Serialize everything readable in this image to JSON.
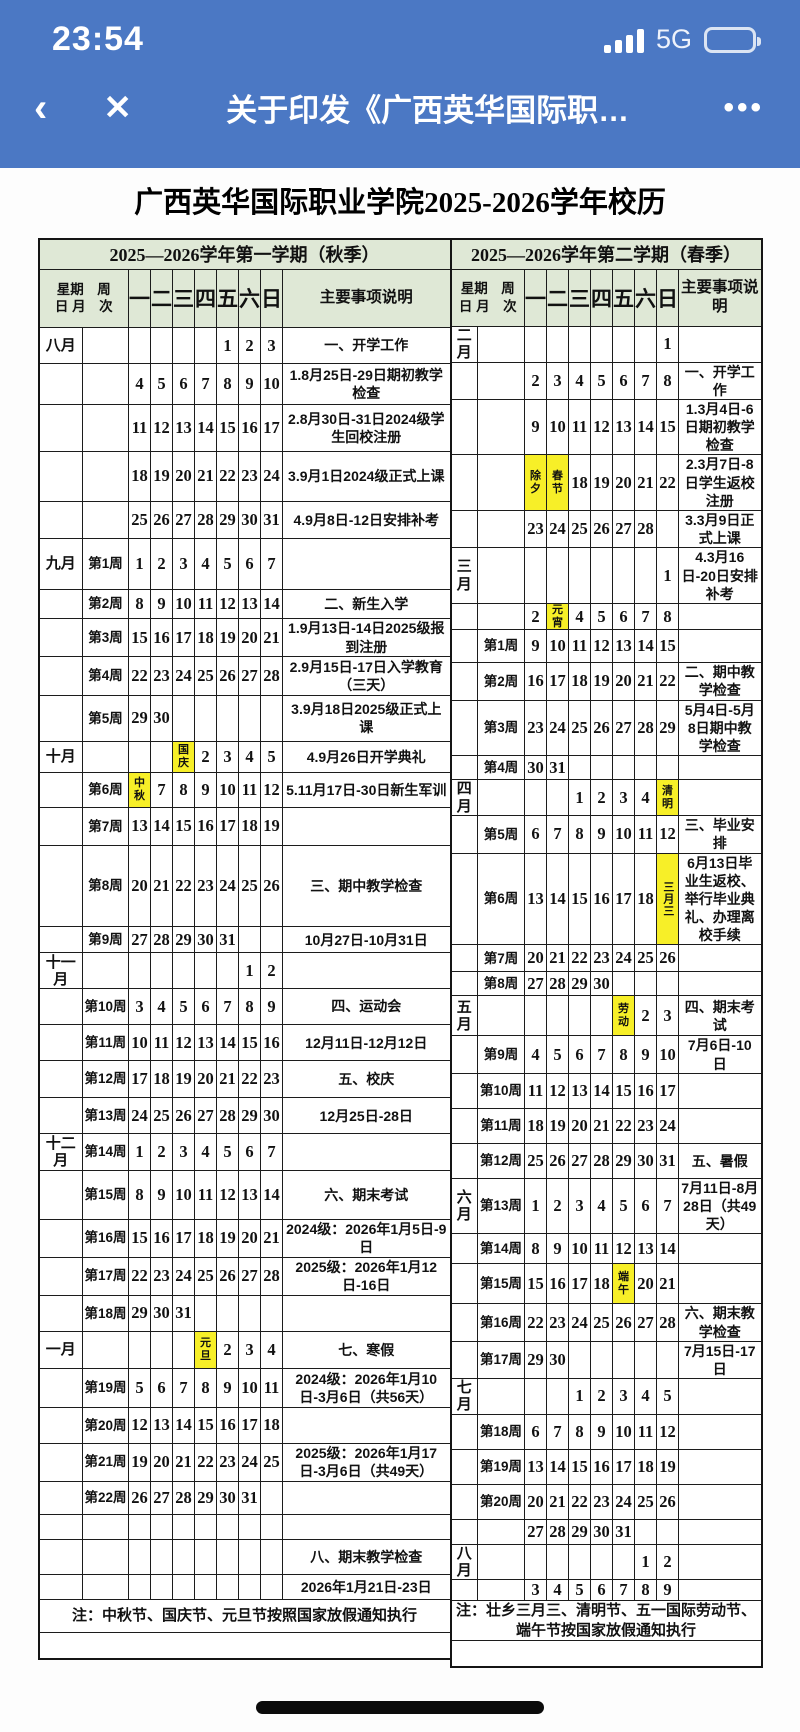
{
  "status_bar": {
    "time": "23:54",
    "network": "5G"
  },
  "nav": {
    "back_icon": "‹",
    "close_icon": "✕",
    "title": "关于印发《广西英华国际职…",
    "more_icon": "•••"
  },
  "page": {
    "title": "广西英华国际职业学院2025-2026学年校历"
  },
  "colors": {
    "nav_blue": "#4b78c4",
    "header_green": "#dfe8d6",
    "holiday_yellow": "#f7ef28"
  },
  "calendars": [
    {
      "title": "2025—2026学年第一学期（秋季）",
      "corner": "星期　周\n日 月　次",
      "day_headers": [
        "一",
        "二",
        "三",
        "四",
        "五",
        "六",
        "日"
      ],
      "notes_header": "主要事项说明",
      "rows": [
        {
          "m": "八月",
          "w": "",
          "d": [
            "",
            "",
            "",
            "",
            "1",
            "2",
            "3"
          ],
          "note": "一、开学工作",
          "h": 36
        },
        {
          "m": "",
          "w": "",
          "d": [
            "4",
            "5",
            "6",
            "7",
            "8",
            "9",
            "10"
          ],
          "note": "1.8月25日-29日期初教学检查",
          "h": 40
        },
        {
          "m": "",
          "w": "",
          "d": [
            "11",
            "12",
            "13",
            "14",
            "15",
            "16",
            "17"
          ],
          "note": "2.8月30日-31日2024级学生回校注册",
          "h": 46
        },
        {
          "m": "",
          "w": "",
          "d": [
            "18",
            "19",
            "20",
            "21",
            "22",
            "23",
            "24"
          ],
          "note": "3.9月1日2024级正式上课",
          "h": 50
        },
        {
          "m": "",
          "w": "",
          "d": [
            "25",
            "26",
            "27",
            "28",
            "29",
            "30",
            "31"
          ],
          "note": "4.9月8日-12日安排补考",
          "h": 36
        },
        {
          "m": "九月",
          "w": "第1周",
          "d": [
            "1",
            "2",
            "3",
            "4",
            "5",
            "6",
            "7"
          ],
          "note": "",
          "h": 50
        },
        {
          "m": "",
          "w": "第2周",
          "d": [
            "8",
            "9",
            "10",
            "11",
            "12",
            "13",
            "14"
          ],
          "note": "二、新生入学",
          "h": 29
        },
        {
          "m": "",
          "w": "第3周",
          "d": [
            "15",
            "16",
            "17",
            "18",
            "19",
            "20",
            "21"
          ],
          "note": "1.9月13日-14日2025级报到注册",
          "h": 33
        },
        {
          "m": "",
          "w": "第4周",
          "d": [
            "22",
            "23",
            "24",
            "25",
            "26",
            "27",
            "28"
          ],
          "note": "2.9月15日-17日入学教育（三天）",
          "h": 38
        },
        {
          "m": "",
          "w": "第5周",
          "d": [
            "29",
            "30",
            "",
            "",
            "",
            "",
            ""
          ],
          "note": "3.9月18日2025级正式上课",
          "h": 46
        },
        {
          "m": "十月",
          "w": "",
          "d": [
            "",
            "",
            {
              "t": "国庆",
              "hl": true
            },
            "2",
            "3",
            "4",
            "5"
          ],
          "note": "4.9月26日开学典礼",
          "h": 30
        },
        {
          "m": "",
          "w": "第6周",
          "d": [
            {
              "t": "中秋",
              "hl": true
            },
            "7",
            "8",
            "9",
            "10",
            "11",
            "12"
          ],
          "note": "5.11月17日-30日新生军训",
          "h": 35
        },
        {
          "m": "",
          "w": "第7周",
          "d": [
            "13",
            "14",
            "15",
            "16",
            "17",
            "18",
            "19"
          ],
          "note": "",
          "h": 37
        },
        {
          "m": "",
          "w": "第8周",
          "d": [
            "20",
            "21",
            "22",
            "23",
            "24",
            "25",
            "26"
          ],
          "note": "三、期中教学检查",
          "h": 80
        },
        {
          "m": "",
          "w": "第9周",
          "d": [
            "27",
            "28",
            "29",
            "30",
            "31",
            "",
            ""
          ],
          "note": "10月27日-10月31日",
          "h": 26
        },
        {
          "m": "十一月",
          "w": "",
          "d": [
            "",
            "",
            "",
            "",
            "",
            "1",
            "2"
          ],
          "note": "",
          "h": 34
        },
        {
          "m": "",
          "w": "第10周",
          "d": [
            "3",
            "4",
            "5",
            "6",
            "7",
            "8",
            "9"
          ],
          "note": "四、运动会",
          "h": 35
        },
        {
          "m": "",
          "w": "第11周",
          "d": [
            "10",
            "11",
            "12",
            "13",
            "14",
            "15",
            "16"
          ],
          "note": "12月11日-12月12日",
          "h": 36
        },
        {
          "m": "",
          "w": "第12周",
          "d": [
            "17",
            "18",
            "19",
            "20",
            "21",
            "22",
            "23"
          ],
          "note": "五、校庆",
          "h": 36
        },
        {
          "m": "",
          "w": "第13周",
          "d": [
            "24",
            "25",
            "26",
            "27",
            "28",
            "29",
            "30"
          ],
          "note": "12月25日-28日",
          "h": 36
        },
        {
          "m": "十二月",
          "w": "第14周",
          "d": [
            "1",
            "2",
            "3",
            "4",
            "5",
            "6",
            "7"
          ],
          "note": "",
          "h": 36
        },
        {
          "m": "",
          "w": "第15周",
          "d": [
            "8",
            "9",
            "10",
            "11",
            "12",
            "13",
            "14"
          ],
          "note": "六、期末考试",
          "h": 48
        },
        {
          "m": "",
          "w": "第16周",
          "d": [
            "15",
            "16",
            "17",
            "18",
            "19",
            "20",
            "21"
          ],
          "note": "2024级：2026年1月5日-9日",
          "h": 37
        },
        {
          "m": "",
          "w": "第17周",
          "d": [
            "22",
            "23",
            "24",
            "25",
            "26",
            "27",
            "28"
          ],
          "note": "2025级：2026年1月12日-16日",
          "h": 35
        },
        {
          "m": "",
          "w": "第18周",
          "d": [
            "29",
            "30",
            "31",
            "",
            "",
            "",
            ""
          ],
          "note": "",
          "h": 36
        },
        {
          "m": "一月",
          "w": "",
          "d": [
            "",
            "",
            "",
            {
              "t": "元旦",
              "hl": true
            },
            "2",
            "3",
            "4"
          ],
          "note": "七、寒假",
          "h": 36
        },
        {
          "m": "",
          "w": "第19周",
          "d": [
            "5",
            "6",
            "7",
            "8",
            "9",
            "10",
            "11"
          ],
          "note": "2024级：2026年1月10日-3月6日（共56天）",
          "h": 39
        },
        {
          "m": "",
          "w": "第20周",
          "d": [
            "12",
            "13",
            "14",
            "15",
            "16",
            "17",
            "18"
          ],
          "note": "",
          "h": 35
        },
        {
          "m": "",
          "w": "第21周",
          "d": [
            "19",
            "20",
            "21",
            "22",
            "23",
            "24",
            "25"
          ],
          "note": "2025级：2026年1月17日-3月6日（共49天）",
          "h": 35
        },
        {
          "m": "",
          "w": "第22周",
          "d": [
            "26",
            "27",
            "28",
            "29",
            "30",
            "31",
            ""
          ],
          "note": "",
          "h": 33
        },
        {
          "m": "",
          "w": "",
          "d": [
            "",
            "",
            "",
            "",
            "",
            "",
            ""
          ],
          "note": "",
          "h": 25
        },
        {
          "m": "",
          "w": "",
          "d": [
            "",
            "",
            "",
            "",
            "",
            "",
            ""
          ],
          "note": "八、期末教学检查",
          "h": 34
        },
        {
          "m": "",
          "w": "",
          "d": [
            "",
            "",
            "",
            "",
            "",
            "",
            ""
          ],
          "note": "2026年1月21日-23日",
          "h": 25
        },
        {
          "span": "注：中秋节、国庆节、元旦节按照国家放假通知执行",
          "h": 32
        },
        {
          "span": "",
          "h": 26
        }
      ]
    },
    {
      "title": "2025—2026学年第二学期（春季）",
      "corner": "星期　周\n日 月　次",
      "day_headers": [
        "一",
        "二",
        "三",
        "四",
        "五",
        "六",
        "日"
      ],
      "notes_header": "主要事项说明",
      "rows": [
        {
          "m": "二月",
          "w": "",
          "d": [
            "",
            "",
            "",
            "",
            "",
            "",
            "1"
          ],
          "note": "",
          "h": 36
        },
        {
          "m": "",
          "w": "",
          "d": [
            "2",
            "3",
            "4",
            "5",
            "6",
            "7",
            "8"
          ],
          "note": "一、开学工作",
          "h": 36
        },
        {
          "m": "",
          "w": "",
          "d": [
            "9",
            "10",
            "11",
            "12",
            "13",
            "14",
            "15"
          ],
          "note": "1.3月4日-6日期初教学检查",
          "h": 48
        },
        {
          "m": "",
          "w": "",
          "d": [
            {
              "t": "除夕",
              "hl": true
            },
            {
              "t": "春节",
              "hl": true
            },
            "18",
            "19",
            "20",
            "21",
            "22"
          ],
          "note": "2.3月7日-8日学生返校注册",
          "h": 53
        },
        {
          "m": "",
          "w": "",
          "d": [
            "23",
            "24",
            "25",
            "26",
            "27",
            "28",
            ""
          ],
          "note": "3.3月9日正式上课",
          "h": 36
        },
        {
          "m": "三月",
          "w": "",
          "d": [
            "",
            "",
            "",
            "",
            "",
            "",
            "1"
          ],
          "note": "4.3月16日-20日安排补考",
          "h": 50
        },
        {
          "m": "",
          "w": "",
          "d": [
            "2",
            {
              "t": "元宵",
              "hl": true
            },
            "4",
            "5",
            "6",
            "7",
            "8"
          ],
          "note": "",
          "h": 26
        },
        {
          "m": "",
          "w": "第1周",
          "d": [
            "9",
            "10",
            "11",
            "12",
            "13",
            "14",
            "15"
          ],
          "note": "",
          "h": 33
        },
        {
          "m": "",
          "w": "第2周",
          "d": [
            "16",
            "17",
            "18",
            "19",
            "20",
            "21",
            "22"
          ],
          "note": "二、期中教学检查",
          "h": 33
        },
        {
          "m": "",
          "w": "第3周",
          "d": [
            "23",
            "24",
            "25",
            "26",
            "27",
            "28",
            "29"
          ],
          "note": "5月4日-5月8日期中教学检查",
          "h": 50
        },
        {
          "m": "",
          "w": "第4周",
          "d": [
            "30",
            "31",
            "",
            "",
            "",
            "",
            ""
          ],
          "note": "",
          "h": 24
        },
        {
          "m": "四月",
          "w": "",
          "d": [
            "",
            "",
            "1",
            "2",
            "3",
            "4",
            {
              "t": "清明",
              "hl": true
            }
          ],
          "note": "",
          "h": 36
        },
        {
          "m": "",
          "w": "第5周",
          "d": [
            "6",
            "7",
            "8",
            "9",
            "10",
            "11",
            "12"
          ],
          "note": "三、毕业安排",
          "h": 35
        },
        {
          "m": "",
          "w": "第6周",
          "d": [
            "13",
            "14",
            "15",
            "16",
            "17",
            "18",
            {
              "t": "三月三",
              "hl": true,
              "vert": true
            }
          ],
          "note": "6月13日毕业生返校、举行毕业典礼、办理离校手续",
          "h": 84
        },
        {
          "m": "",
          "w": "第7周",
          "d": [
            "20",
            "21",
            "22",
            "23",
            "24",
            "25",
            "26"
          ],
          "note": "",
          "h": 27
        },
        {
          "m": "",
          "w": "第8周",
          "d": [
            "27",
            "28",
            "29",
            "30",
            "",
            "",
            ""
          ],
          "note": "",
          "h": 24
        },
        {
          "m": "五月",
          "w": "",
          "d": [
            "",
            "",
            "",
            "",
            {
              "t": "劳动",
              "hl": true
            },
            "2",
            "3"
          ],
          "note": "四、期末考试",
          "h": 40
        },
        {
          "m": "",
          "w": "第9周",
          "d": [
            "4",
            "5",
            "6",
            "7",
            "8",
            "9",
            "10"
          ],
          "note": "7月6日-10日",
          "h": 37
        },
        {
          "m": "",
          "w": "第10周",
          "d": [
            "11",
            "12",
            "13",
            "14",
            "15",
            "16",
            "17"
          ],
          "note": "",
          "h": 35
        },
        {
          "m": "",
          "w": "第11周",
          "d": [
            "18",
            "19",
            "20",
            "21",
            "22",
            "23",
            "24"
          ],
          "note": "",
          "h": 35
        },
        {
          "m": "",
          "w": "第12周",
          "d": [
            "25",
            "26",
            "27",
            "28",
            "29",
            "30",
            "31"
          ],
          "note": "五、暑假",
          "h": 35
        },
        {
          "m": "六月",
          "w": "第13周",
          "d": [
            "1",
            "2",
            "3",
            "4",
            "5",
            "6",
            "7"
          ],
          "note": "7月11日-8月28日（共49天）",
          "h": 49
        },
        {
          "m": "",
          "w": "第14周",
          "d": [
            "8",
            "9",
            "10",
            "11",
            "12",
            "13",
            "14"
          ],
          "note": "",
          "h": 30
        },
        {
          "m": "",
          "w": "第15周",
          "d": [
            "15",
            "16",
            "17",
            "18",
            {
              "t": "端午",
              "hl": true
            },
            "20",
            "21"
          ],
          "note": "",
          "h": 40
        },
        {
          "m": "",
          "w": "第16周",
          "d": [
            "22",
            "23",
            "24",
            "25",
            "26",
            "27",
            "28"
          ],
          "note": "六、期末教学检查",
          "h": 37
        },
        {
          "m": "",
          "w": "第17周",
          "d": [
            "29",
            "30",
            "",
            "",
            "",
            "",
            ""
          ],
          "note": "7月15日-17日",
          "h": 35
        },
        {
          "m": "七月",
          "w": "",
          "d": [
            "",
            "",
            "1",
            "2",
            "3",
            "4",
            "5"
          ],
          "note": "",
          "h": 35
        },
        {
          "m": "",
          "w": "第18周",
          "d": [
            "6",
            "7",
            "8",
            "9",
            "10",
            "11",
            "12"
          ],
          "note": "",
          "h": 35
        },
        {
          "m": "",
          "w": "第19周",
          "d": [
            "13",
            "14",
            "15",
            "16",
            "17",
            "18",
            "19"
          ],
          "note": "",
          "h": 35
        },
        {
          "m": "",
          "w": "第20周",
          "d": [
            "20",
            "21",
            "22",
            "23",
            "24",
            "25",
            "26"
          ],
          "note": "",
          "h": 35
        },
        {
          "m": "",
          "w": "",
          "d": [
            "27",
            "28",
            "29",
            "30",
            "31",
            "",
            ""
          ],
          "note": "",
          "h": 25
        },
        {
          "m": "八月",
          "w": "",
          "d": [
            "",
            "",
            "",
            "",
            "",
            "1",
            "2"
          ],
          "note": "",
          "h": 35
        },
        {
          "m": "",
          "w": "",
          "d": [
            "3",
            "4",
            "5",
            "6",
            "7",
            "8",
            "9"
          ],
          "note": "",
          "h": 20
        },
        {
          "span": "注：壮乡三月三、清明节、五一国际劳动节、端午节按国家放假通知执行",
          "h": 32
        },
        {
          "span": "",
          "h": 26
        }
      ]
    }
  ]
}
